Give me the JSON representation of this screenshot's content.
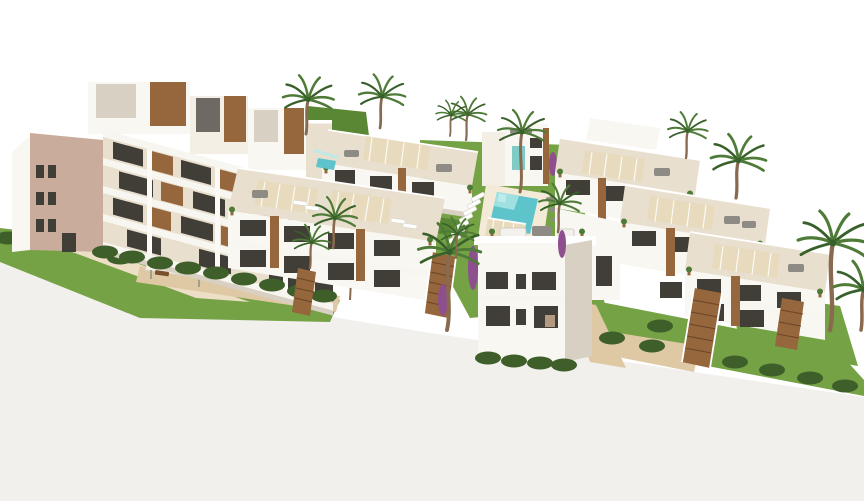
{
  "scene": {
    "type": "3d-architectural-render",
    "description": "Aerial 3D render of a modern Mediterranean residential complex on a white background: a four-storey terraced apartment block with wood-clad penthouses on the left, rows of two-storey white townhouses with roof terraces, pergolas and wooden exterior stairs in the center and right, a communal lawn garden with a turquoise swimming pool and white sun loungers, tan walkways with benches, green hedges and many palm trees.",
    "colors": {
      "bg": "#ffffff",
      "ground": "#f1f0ed",
      "wallWhite": "#f9f7f2",
      "wallCream": "#e9dfcf",
      "wallLight": "#f4efe5",
      "wallMauve": "#c9ac9b",
      "slab": "#f8f6f0",
      "shadow": "#d8d0c2",
      "windowDark": "#413d37",
      "wood": "#96663c",
      "woodDark": "#7a4f2c",
      "grass": "#74a244",
      "grassDark": "#5a8733",
      "hedge": "#3e5e2a",
      "palm": "#4e7b38",
      "palmDark": "#38602a",
      "trunk": "#8a6a4e",
      "pool": "#5ec4cb",
      "poolLight": "#9fe0e0",
      "deck": "#f3ead8",
      "path": "#dfc9a4",
      "pathLight": "#ecdfc6",
      "pergola": "#e7dabd",
      "furniture": "#8e8a84",
      "purple": "#8e4f8e"
    },
    "objects": [
      {
        "name": "apartment-block-left",
        "label": "4-storey terraced apartment building with wood-clad penthouses and stacked balconies"
      },
      {
        "name": "townhouse-cluster-center",
        "label": "two rows of two-storey townhouses with roof terraces and pergolas"
      },
      {
        "name": "townhouse-cluster-right",
        "label": "stepped rows of two-storey townhouses with roof terraces and wooden stairs"
      },
      {
        "name": "foreground-house",
        "label": "white two-storey house with furnished roof terrace and bougainvillea"
      },
      {
        "name": "center-tower",
        "label": "taller white block with teal glass stairwell"
      },
      {
        "name": "swimming-pool",
        "label": "turquoise communal pool with white deck"
      },
      {
        "name": "garden",
        "label": "lawns, hedges and tan walkways"
      },
      {
        "name": "sun-loungers",
        "count": 14
      },
      {
        "name": "palm-trees",
        "count": 14
      },
      {
        "name": "pergolas",
        "count": 7
      },
      {
        "name": "benches",
        "count": 3
      },
      {
        "name": "wooden-staircases",
        "count": 4
      }
    ]
  }
}
